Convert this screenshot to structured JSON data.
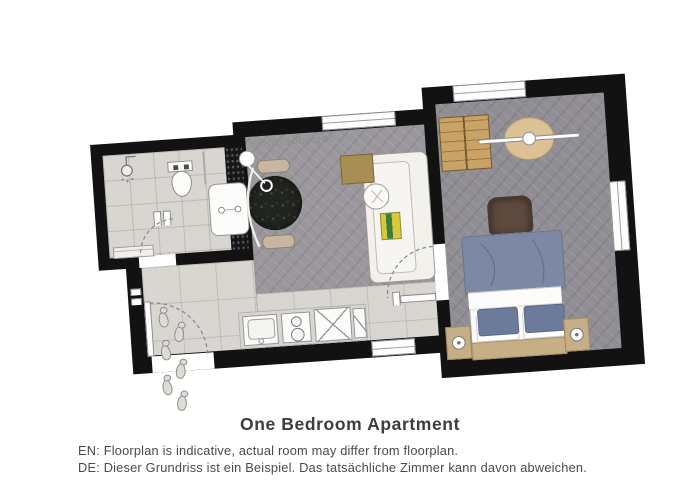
{
  "caption": {
    "title": "One Bedroom Apartment",
    "line_en": "EN: Floorplan is indicative, actual room may differ from floorplan.",
    "line_de": "DE: Dieser Grundriss ist ein Beispiel. Das tatsächliche Zimmer kann davon abweichen."
  },
  "floorplan": {
    "style": "top-down architectural floorplan rendering, slightly rotated, black walls on white background",
    "rotation_deg": -4,
    "rooms": [
      {
        "name": "bathroom",
        "position": "top-left",
        "floor": "light-tile",
        "features": [
          "shower-head",
          "glass-divider",
          "toilet",
          "vanity-sink",
          "bench",
          "dark-mosaic-wall",
          "door-swing"
        ]
      },
      {
        "name": "living-room",
        "position": "center",
        "floor": "gray-parquet",
        "features": [
          "window-top",
          "radiator",
          "pendant-lamp",
          "round-marble-dining-table",
          "chair",
          "chair",
          "arc-floor-lamp",
          "sofa",
          "side-table",
          "round-side-table",
          "book"
        ]
      },
      {
        "name": "bedroom",
        "position": "right",
        "floor": "gray-parquet",
        "features": [
          "window-top",
          "window-right",
          "radiator-top",
          "radiator-right",
          "wardrobe",
          "ceiling-fan",
          "ottoman",
          "double-bed",
          "duvet",
          "pillow",
          "pillow",
          "nightstand-left",
          "nightstand-right",
          "nightstand-lamps",
          "door-swing"
        ]
      },
      {
        "name": "kitchen-hallway",
        "position": "bottom",
        "floor": "light-tile",
        "features": [
          "kitchen-counter",
          "sink",
          "stove-two-burners",
          "cabinet-x",
          "cabinet-narrow",
          "entrance-door-swing",
          "footprints",
          "bottom-window"
        ]
      }
    ],
    "colors": {
      "wall": "#121212",
      "floor_tile": "#d9d5d1",
      "floor_living": "#9a979c",
      "floor_bedroom": "#908e94",
      "dark_mosaic": "#17171a",
      "table_marble": "#22251f",
      "chair_tan": "#c7b6a0",
      "sofa_white": "#f3f1ec",
      "side_table": "#a98e54",
      "book_yellow": "#d6c93a",
      "book_green": "#3c7a3f",
      "wardrobe_wood": "#c9a266",
      "fan_beige": "#dcc096",
      "ottoman_brown": "#5e4a3e",
      "duvet_blue": "#7c88a4",
      "pillow_blue": "#6d7b9b",
      "nightstand_tan": "#c6ae86",
      "title_color": "#3d3d3d",
      "caption_color": "#4a4a4a"
    }
  }
}
